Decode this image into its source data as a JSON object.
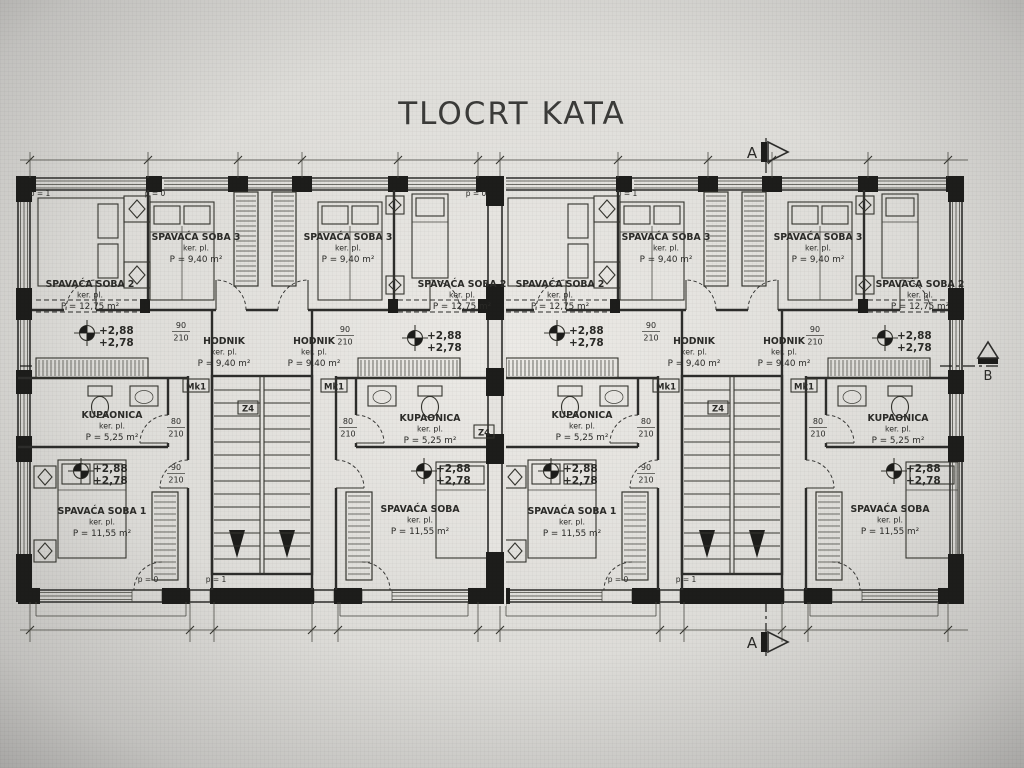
{
  "title": "TLOCRT KATA",
  "section_markers": {
    "top": "A",
    "bottom": "A",
    "side": "B"
  },
  "labels": {
    "sub": "ker. pl."
  },
  "rooms": [
    {
      "name": "SPAVAĆA SOBA 2",
      "area": "P = 12,75 m²",
      "x": 90,
      "y": 287
    },
    {
      "name": "SPAVAĆA SOBA 3",
      "area": "P = 9,40 m²",
      "x": 196,
      "y": 240
    },
    {
      "name": "SPAVAĆA SOBA 3",
      "area": "P = 9,40 m²",
      "x": 348,
      "y": 240
    },
    {
      "name": "SPAVAĆA SOBA 2",
      "area": "P = 12,75 m²",
      "x": 462,
      "y": 287
    },
    {
      "name": "HODNIK",
      "area": "P = 9,40 m²",
      "x": 224,
      "y": 344
    },
    {
      "name": "HODNIK",
      "area": "P = 9,40 m²",
      "x": 314,
      "y": 344
    },
    {
      "name": "KUPAONICA",
      "area": "P = 5,25 m²",
      "x": 112,
      "y": 418
    },
    {
      "name": "KUPAONICA",
      "area": "P = 5,25 m²",
      "x": 430,
      "y": 421
    },
    {
      "name": "SPAVAĆA SOBA 1",
      "area": "P = 11,55 m²",
      "x": 102,
      "y": 514
    },
    {
      "name": "SPAVAĆA SOBA",
      "area": "P = 11,55 m²",
      "x": 420,
      "y": 512
    },
    {
      "name": "SPAVAĆA SOBA 2",
      "area": "P = 12,75 m²",
      "x": 560,
      "y": 287
    },
    {
      "name": "SPAVAĆA SOBA 3",
      "area": "P = 9,40 m²",
      "x": 666,
      "y": 240
    },
    {
      "name": "SPAVAĆA SOBA 3",
      "area": "P = 9,40 m²",
      "x": 818,
      "y": 240
    },
    {
      "name": "SPAVAĆA SOBA 2",
      "area": "P = 12,75 m²",
      "x": 920,
      "y": 287
    },
    {
      "name": "HODNIK",
      "area": "P = 9,40 m²",
      "x": 694,
      "y": 344
    },
    {
      "name": "HODNIK",
      "area": "P = 9,40 m²",
      "x": 784,
      "y": 344
    },
    {
      "name": "KUPAONICA",
      "area": "P = 5,25 m²",
      "x": 582,
      "y": 418
    },
    {
      "name": "KUPAONICA",
      "area": "P = 5,25 m²",
      "x": 898,
      "y": 421
    },
    {
      "name": "SPAVAĆA SOBA 1",
      "area": "P = 11,55 m²",
      "x": 572,
      "y": 514
    },
    {
      "name": "SPAVAĆA SOBA",
      "area": "P = 11,55 m²",
      "x": 890,
      "y": 512
    }
  ],
  "elevations": {
    "upper": "+2,88",
    "lower": "+2,78",
    "points": [
      [
        87,
        333
      ],
      [
        415,
        338
      ],
      [
        557,
        333
      ],
      [
        885,
        338
      ],
      [
        81,
        471
      ],
      [
        424,
        471
      ],
      [
        551,
        471
      ],
      [
        894,
        471
      ]
    ]
  },
  "door_dims": [
    {
      "w": "90",
      "h": "210",
      "x": 181,
      "y": 328
    },
    {
      "w": "90",
      "h": "210",
      "x": 345,
      "y": 332
    },
    {
      "w": "80",
      "h": "210",
      "x": 176,
      "y": 424
    },
    {
      "w": "90",
      "h": "210",
      "x": 176,
      "y": 470
    },
    {
      "w": "80",
      "h": "210",
      "x": 348,
      "y": 424
    },
    {
      "w": "90",
      "h": "210",
      "x": 651,
      "y": 328
    },
    {
      "w": "90",
      "h": "210",
      "x": 815,
      "y": 332
    },
    {
      "w": "80",
      "h": "210",
      "x": 646,
      "y": 424
    },
    {
      "w": "90",
      "h": "210",
      "x": 646,
      "y": 470
    },
    {
      "w": "80",
      "h": "210",
      "x": 818,
      "y": 424
    }
  ],
  "marks": [
    {
      "text": "Mk1",
      "x": 196,
      "y": 386
    },
    {
      "text": "Mk1",
      "x": 334,
      "y": 386
    },
    {
      "text": "Mk1",
      "x": 666,
      "y": 386
    },
    {
      "text": "Mk1",
      "x": 804,
      "y": 386
    },
    {
      "text": "Z4",
      "x": 248,
      "y": 408
    },
    {
      "text": "Z4",
      "x": 484,
      "y": 432
    },
    {
      "text": "Z4",
      "x": 718,
      "y": 408
    }
  ],
  "level_marks": [
    {
      "text": "p = 1",
      "x": 40,
      "y": 196
    },
    {
      "text": "p = 0",
      "x": 155,
      "y": 196
    },
    {
      "text": "p = 0",
      "x": 476,
      "y": 196
    },
    {
      "text": "p = 1",
      "x": 627,
      "y": 196
    },
    {
      "text": "p = 0",
      "x": 148,
      "y": 582
    },
    {
      "text": "p = 1",
      "x": 216,
      "y": 582
    },
    {
      "text": "p = 0",
      "x": 618,
      "y": 582
    },
    {
      "text": "p = 1",
      "x": 686,
      "y": 582
    }
  ]
}
